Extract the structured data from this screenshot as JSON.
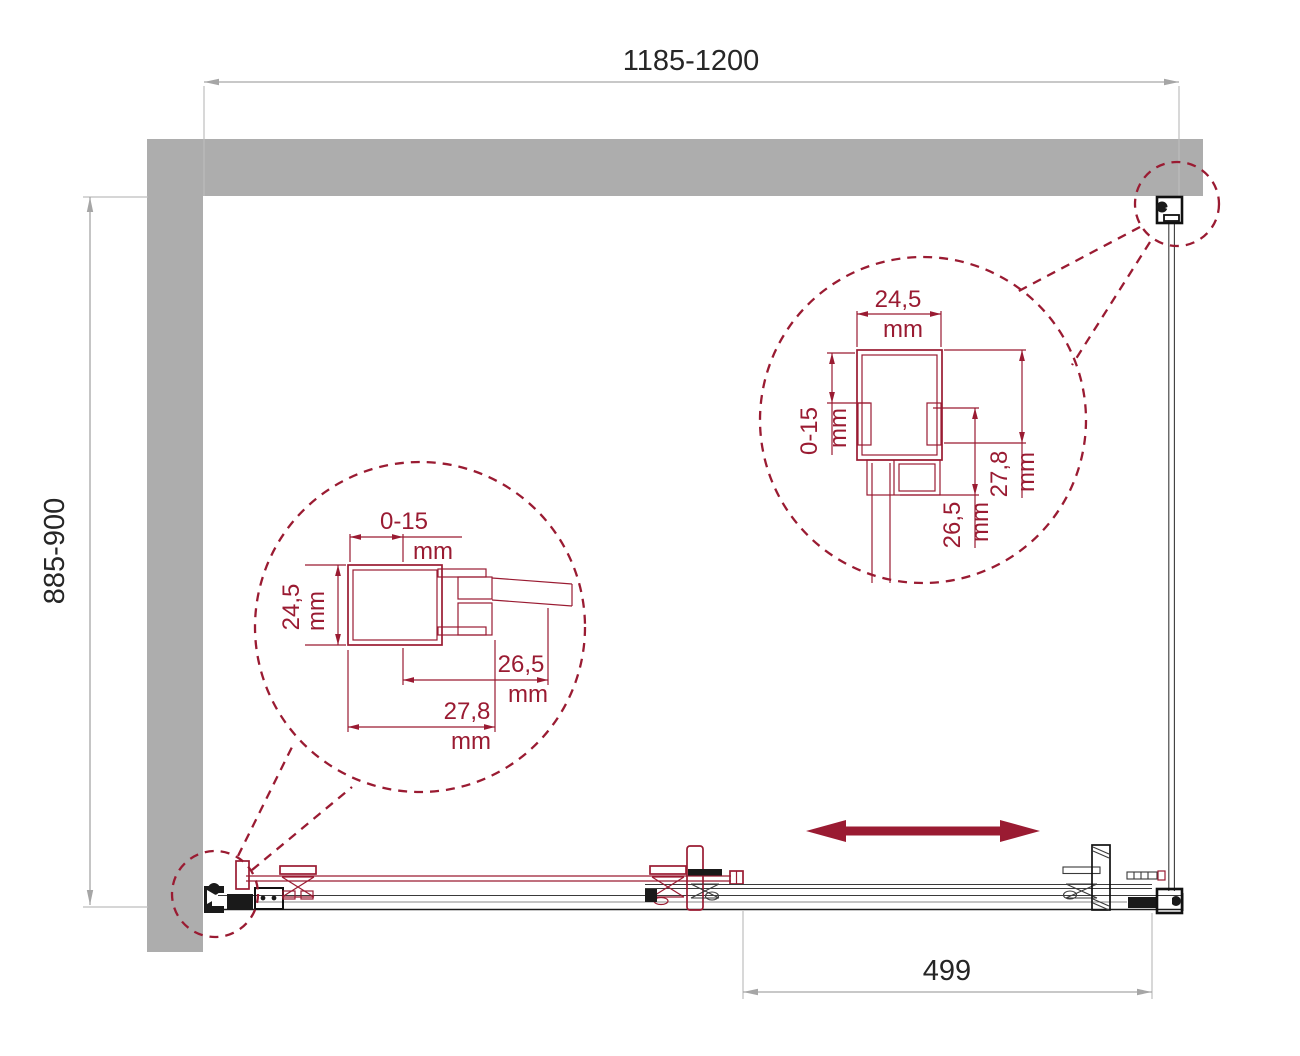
{
  "dimensions": {
    "width": "1185-1200",
    "depth": "885-900",
    "door_travel": "499"
  },
  "detail_left": {
    "adjust": "0-15",
    "profile_width": "24,5",
    "inner_depth": "26,5",
    "outer_depth": "27,8",
    "unit": "mm"
  },
  "detail_right": {
    "adjust": "0-15",
    "profile_width": "24,5",
    "inner_depth": "26,5",
    "outer_depth": "27,8",
    "unit": "mm"
  },
  "colors": {
    "wall_gray": "#ADADAD",
    "dimension_gray": "#A6A6A6",
    "accent_dark_red": "#9A1B32",
    "line_black": "#1A1A1A",
    "text_black": "#262626",
    "background": "#FFFFFF"
  }
}
